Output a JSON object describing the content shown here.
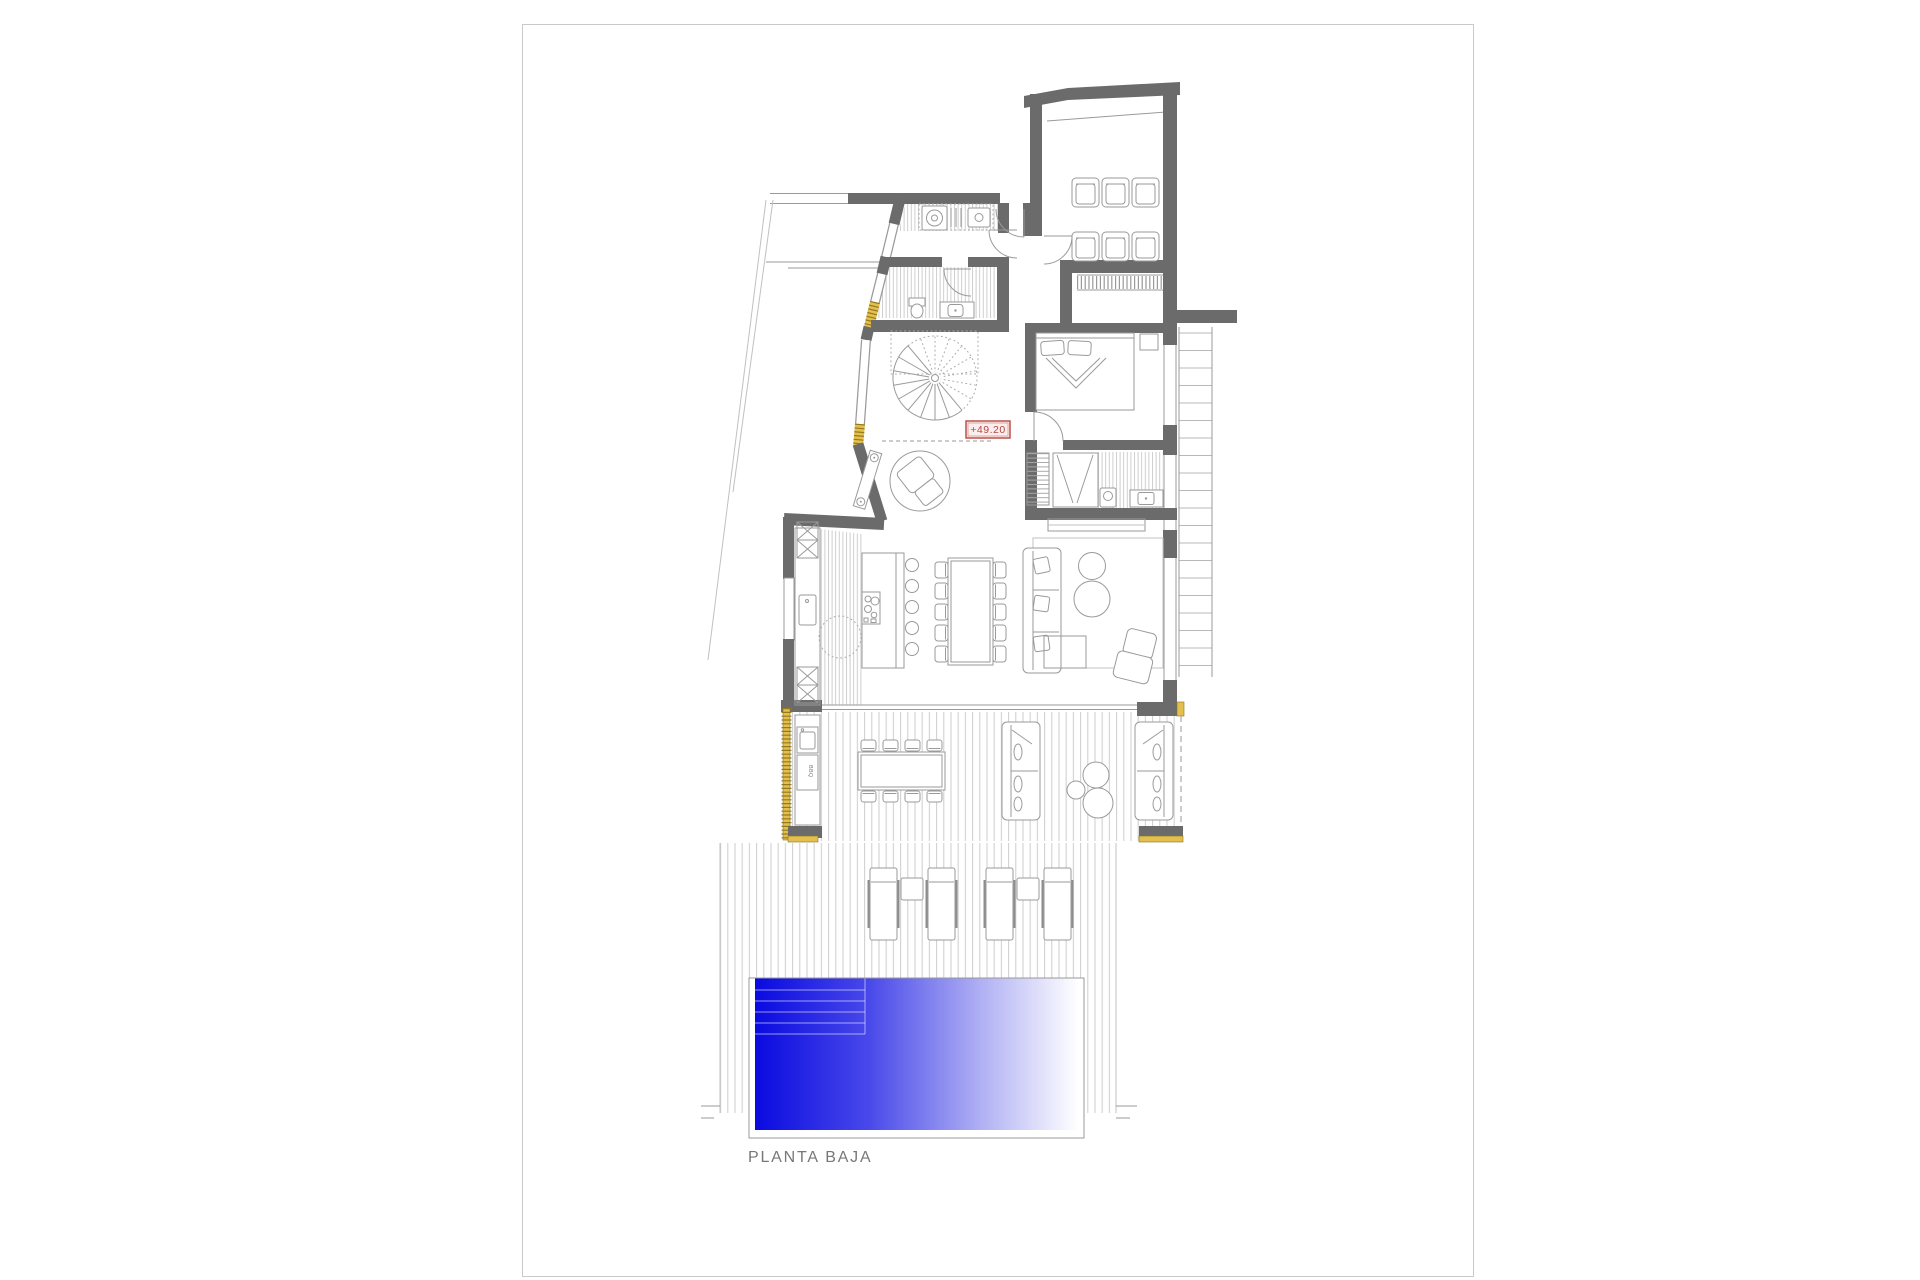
{
  "sheet": {
    "title_label": "PLANTA BAJA"
  },
  "annotations": {
    "level_marker": "+49.20",
    "bbq_label": "BBQ"
  },
  "colors": {
    "wall": "#6b6b6b",
    "line": "#9a9a9a",
    "hatch": "#c9c9c9",
    "window_accent": "#e3c04d",
    "window_accent_dark": "#95791f",
    "marker_red": "#b5473e",
    "marker_fill": "#fceeee",
    "paper_border": "#c9c9c9",
    "label_gray": "#787878"
  }
}
